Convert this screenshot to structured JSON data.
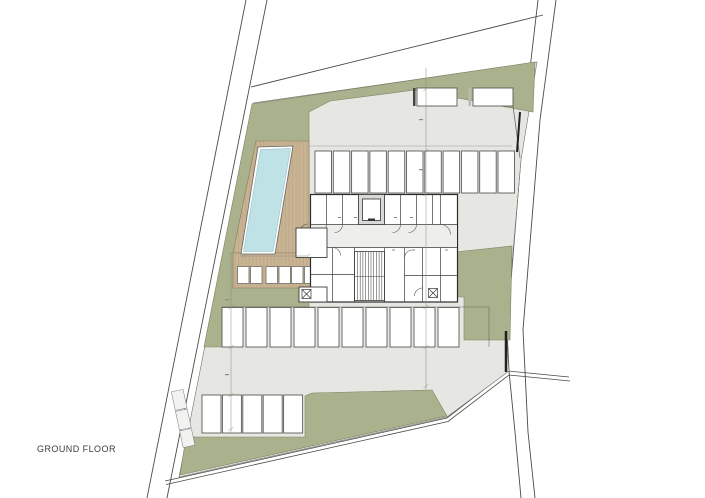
{
  "plan": {
    "floor_label": "GROUND FLOOR",
    "colors": {
      "background": "#ffffff",
      "paving_gray": "#e6e7e3",
      "landscape_green": "#a9b28c",
      "deck_tan": "#c8b393",
      "deck_plank_line": "#b09a78",
      "pool_blue": "#bfe2e6",
      "line_dark": "#4a4b46",
      "wall_black": "#2b2b2a"
    },
    "site": {
      "parking_stalls": {
        "top_row": 2,
        "upper_row": 11,
        "middle_row": 10,
        "bottom_row": 5
      },
      "sun_loungers": 6,
      "features": [
        "swimming-pool",
        "timber-deck",
        "landscaped-garden",
        "paved-parking-court",
        "building-core-storage-cells",
        "staircase",
        "elevator",
        "site-boundary",
        "roads"
      ]
    }
  }
}
